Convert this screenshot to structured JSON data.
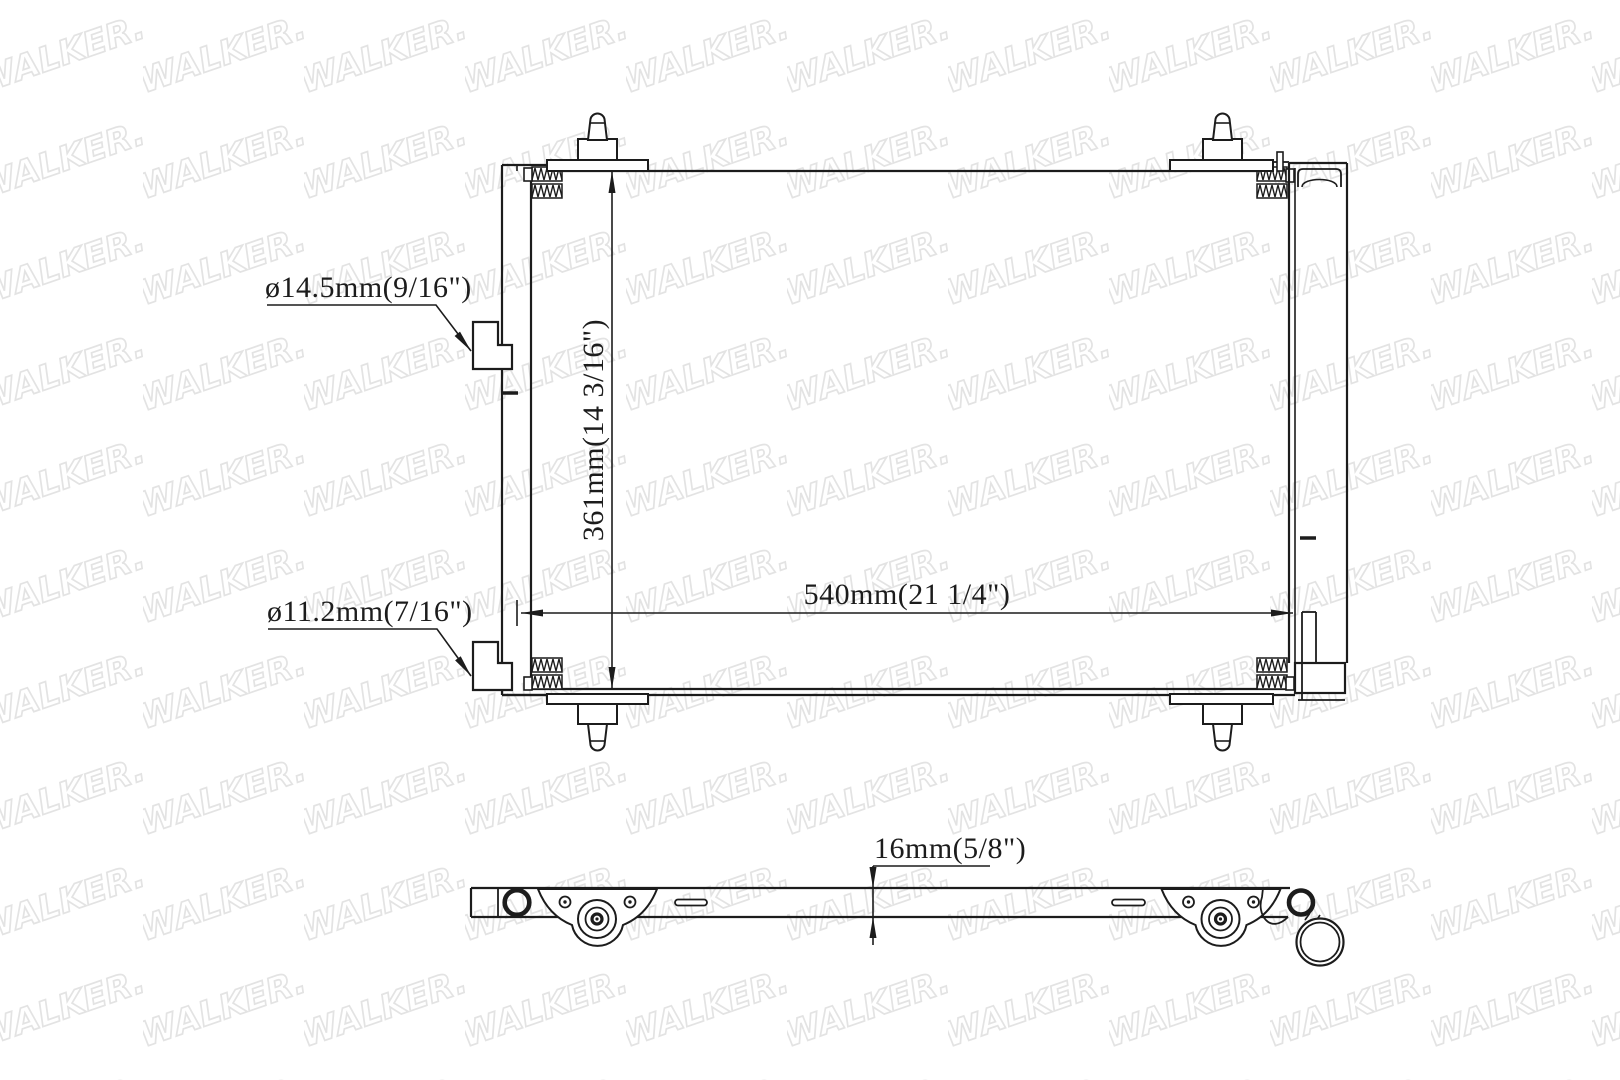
{
  "watermark": {
    "text": "WALKER.",
    "color": "#e3e3e3"
  },
  "drawing": {
    "ink_color": "#1c1c1c",
    "background_color": "#ffffff",
    "dimensions": {
      "upper_port_diameter": "ø14.5mm(9/16\")",
      "lower_port_diameter": "ø11.2mm(7/16\")",
      "core_height": "361mm(14 3/16\")",
      "core_width": "540mm(21 1/4\")",
      "core_depth": "16mm(5/8\")"
    }
  }
}
